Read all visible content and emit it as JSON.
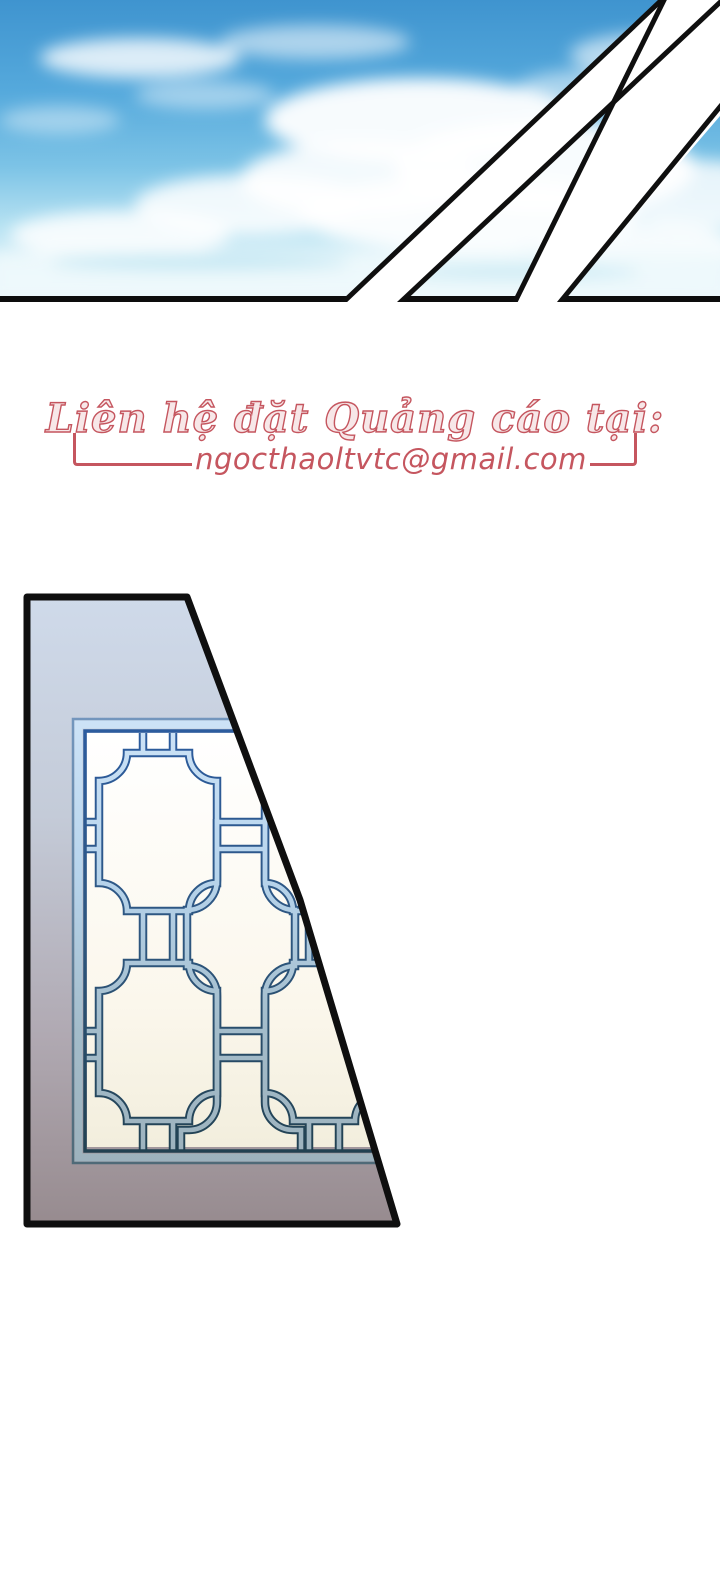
{
  "ad_contact": {
    "heading": "Liên hệ đặt Quảng cáo tại:",
    "email": "ngocthaoltvtc@gmail.com"
  },
  "colors": {
    "accent": "#c5565f",
    "page_bg": "#ffffff",
    "panel_border": "#0f0f0f",
    "sky_top": "#3f94cf",
    "sky_horizon": "#edf8fc",
    "cloud_white": "#ffffff",
    "lattice_outline_top": "#2c5ca0",
    "lattice_outline_bottom": "#21404f",
    "lattice_fill_top": "#cde3f7",
    "lattice_fill_bottom": "#9db2bd",
    "wall_top": "#ccd7e8",
    "wall_bottom": "#8e8287",
    "window_bg_top": "#ffffff",
    "window_bg_bottom": "#f2eedd"
  },
  "illustrations": {
    "sky_panel": "sky-with-clouds-cut-by-diagonal-slash-bands",
    "window_panel": "trapezoid-wall-with-chinese-lattice-window"
  }
}
